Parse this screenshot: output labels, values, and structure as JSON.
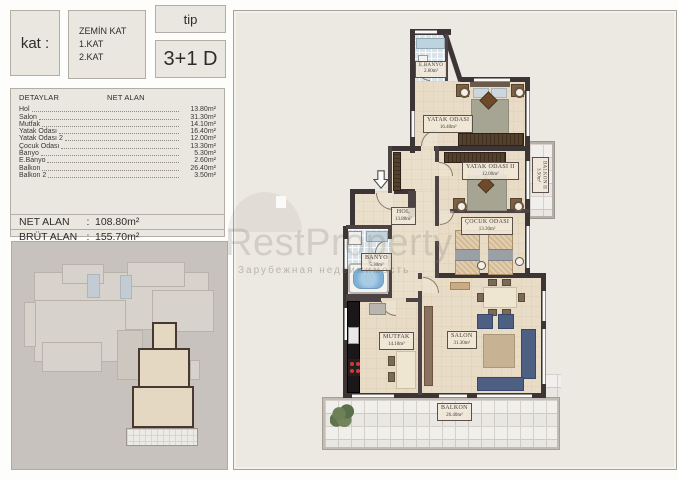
{
  "header": {
    "kat_label": "kat :",
    "floor_lines": [
      "ZEMİN KAT",
      "1.KAT",
      "2.KAT"
    ],
    "tip_label": "tip",
    "type_value": "3+1 D"
  },
  "details": {
    "columns": {
      "name": "DETAYLAR",
      "area": "NET ALAN"
    },
    "items": [
      {
        "name": "Hol",
        "area": "13.80m²"
      },
      {
        "name": "Salon",
        "area": "31.30m²"
      },
      {
        "name": "Mutfak",
        "area": "14.10m²"
      },
      {
        "name": "Yatak Odası",
        "area": "16.40m²"
      },
      {
        "name": "Yatak Odası 2",
        "area": "12.00m²"
      },
      {
        "name": "Çocuk Odası",
        "area": "13.30m²"
      },
      {
        "name": "Banyo",
        "area": "5.30m²"
      },
      {
        "name": "E.Banyo",
        "area": "2.60m²"
      },
      {
        "name": "Balkon",
        "area": "26.40m²"
      },
      {
        "name": "Balkon 2",
        "area": "3.50m²"
      }
    ],
    "net": {
      "label": "NET ALAN",
      "sep": ":",
      "value": "108.80m²"
    },
    "brut": {
      "label": "BRÜT ALAN",
      "sep": ":",
      "value": "155.70m²"
    }
  },
  "plan": {
    "rooms": {
      "ebanyo": {
        "name": "E.BANYO",
        "area": "2.60m²"
      },
      "yatak1": {
        "name": "YATAK ODASI",
        "area": "16.40m²"
      },
      "yatak2": {
        "name": "YATAK ODASI II",
        "area": "12.00m²"
      },
      "cocuk": {
        "name": "ÇOCUK ODASI",
        "area": "13.30m²"
      },
      "hol": {
        "name": "HOL",
        "area": "13.80m²"
      },
      "banyo": {
        "name": "BANYO",
        "area": "5.30m²"
      },
      "mutfak": {
        "name": "MUTFAK",
        "area": "14.10m²"
      },
      "salon": {
        "name": "SALON",
        "area": "31.30m²"
      },
      "balkon": {
        "name": "BALKON",
        "area": "26.40m²"
      },
      "balkon2": {
        "name": "BALKON II",
        "area": "3.50m²"
      }
    }
  },
  "watermark": {
    "brand": "RestProperty",
    "subtitle": "Зарубежная недвижимость"
  },
  "colors": {
    "wall": "#3d3436",
    "sofa": "#4d6083",
    "tile_blue": "#d9e4ea",
    "floor": "#e8dcc6"
  }
}
